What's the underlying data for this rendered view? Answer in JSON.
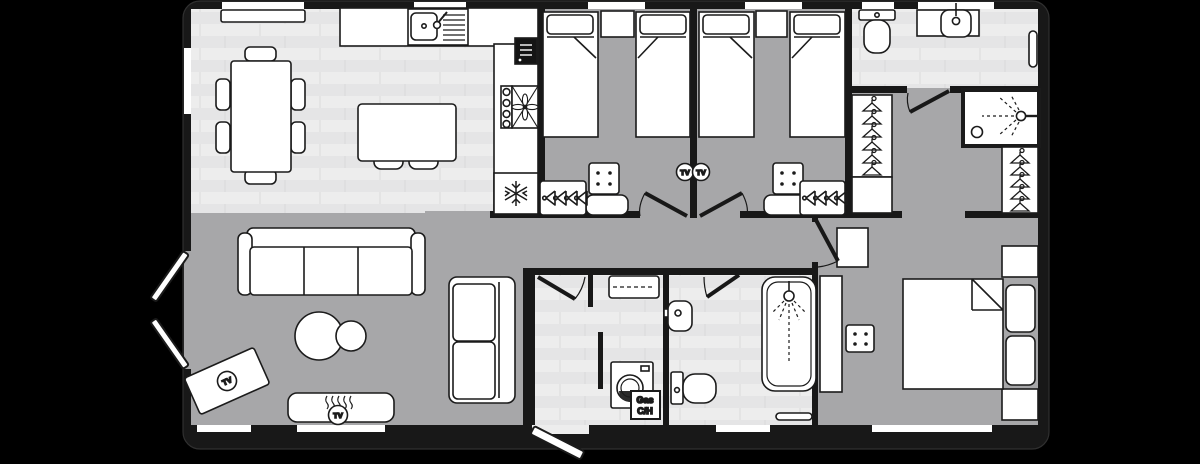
{
  "title": "Holiday lodge floor plan",
  "labels": {
    "tv": "TV",
    "gas_1": "Gas",
    "gas_2": "C/H"
  },
  "colors": {
    "background": "#000000",
    "walls": "#181818",
    "carpet": "#a7a7a9",
    "wood_floor": "#ededed",
    "furniture_fill": "#ffffff",
    "outline": "#1b1b1b"
  },
  "icons": [
    "snowflake-icon",
    "extractor-fan-icon",
    "shower-spray-icon",
    "hanger-icon",
    "coat-hooks-icon",
    "tv-badge",
    "flame-icon",
    "washing-machine-icon"
  ],
  "rooms": [
    {
      "name": "Open-plan dining / kitchen",
      "floor": "wood",
      "furniture": [
        "sideboard",
        "dining table with 6 chairs",
        "sink with drainer and tap",
        "microwave",
        "hob with extractor fan",
        "fridge with snowflake symbol",
        "breakfast island with 2 stools"
      ]
    },
    {
      "name": "Lounge",
      "floor": "carpet",
      "furniture": [
        "3-seat sofa",
        "2-seat sofa",
        "2 round coffee tables",
        "corner TV unit (TV)",
        "fireplace with wall TV",
        "french doors",
        "window"
      ]
    },
    {
      "name": "Twin bedroom 1",
      "floor": "carpet",
      "furniture": [
        "2 single beds",
        "headboard shelf",
        "drawer unit",
        "coat hooks",
        "wall TV"
      ]
    },
    {
      "name": "Twin bedroom 2",
      "floor": "carpet",
      "furniture": [
        "2 single beds",
        "headboard shelf",
        "drawer unit",
        "coat hooks",
        "wall TV"
      ]
    },
    {
      "name": "Entrance hall / utility",
      "floor": "wood",
      "furniture": [
        "entrance door",
        "overhead cupboard (dashed)",
        "washing machine",
        "gas central heating boiler"
      ]
    },
    {
      "name": "Family bathroom",
      "floor": "wood",
      "furniture": [
        "bath with shower over",
        "basin",
        "toilet",
        "towel rail"
      ]
    },
    {
      "name": "Dressing area",
      "floor": "carpet",
      "furniture": [
        "hanging wardrobe",
        "shelf unit",
        "hanging wardrobe"
      ]
    },
    {
      "name": "En-suite shower room",
      "floor": "wood",
      "furniture": [
        "shower cubicle",
        "toilet",
        "basin with counter",
        "towel rail"
      ]
    },
    {
      "name": "Master bedroom",
      "floor": "carpet",
      "furniture": [
        "double bed",
        "2 bedside cabinets",
        "ottoman",
        "wardrobe",
        "cupboard",
        "window"
      ]
    }
  ]
}
